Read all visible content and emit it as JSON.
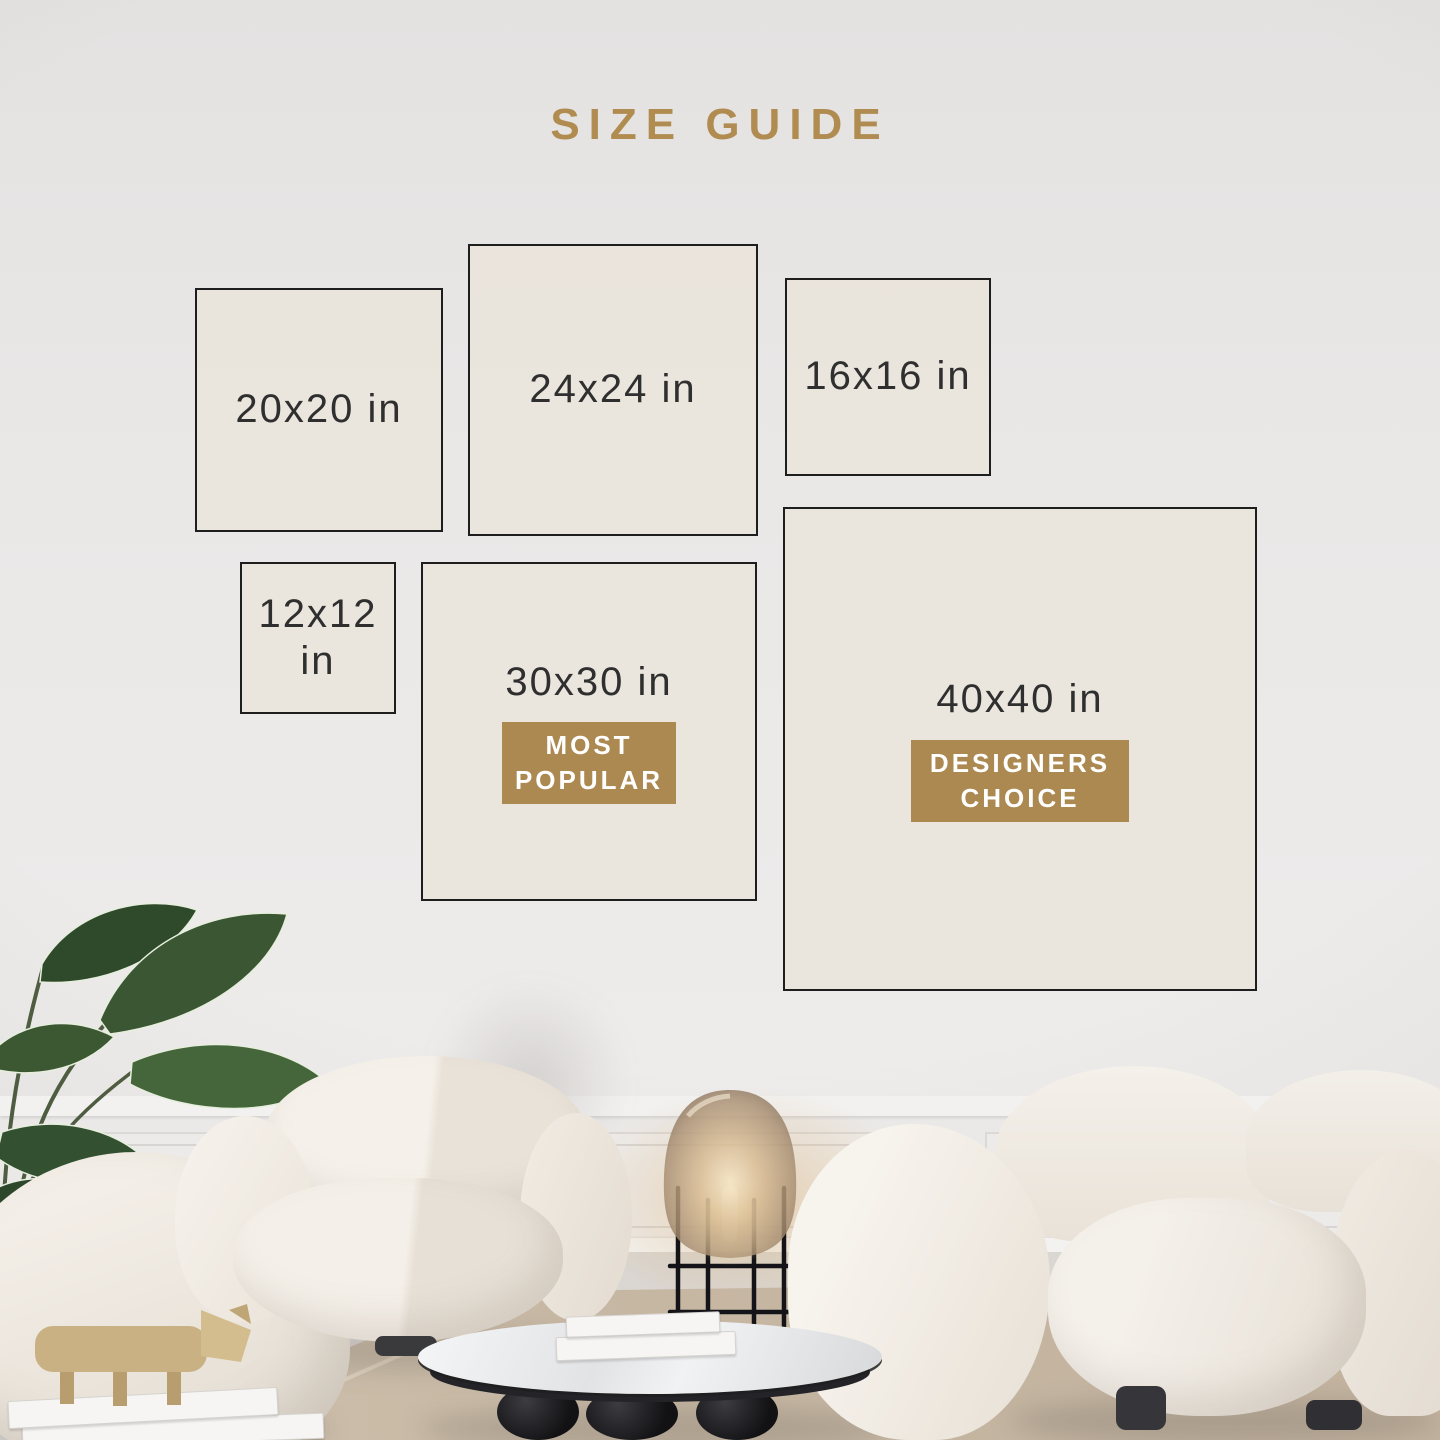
{
  "title": "SIZE GUIDE",
  "colors": {
    "accent_gold": "#b08c51",
    "box_border": "#1e1e1e",
    "box_fill": "#e9e4dc",
    "label_text": "#2f2f2f",
    "badge_text": "#ffffff"
  },
  "sizes": [
    {
      "label": "20x20 in"
    },
    {
      "label": "24x24 in"
    },
    {
      "label": "16x16 in"
    },
    {
      "label": "12x12 in"
    },
    {
      "label": "30x30 in",
      "badge": "MOST POPULAR"
    },
    {
      "label": "40x40 in",
      "badge": "DESIGNERS CHOICE"
    }
  ]
}
